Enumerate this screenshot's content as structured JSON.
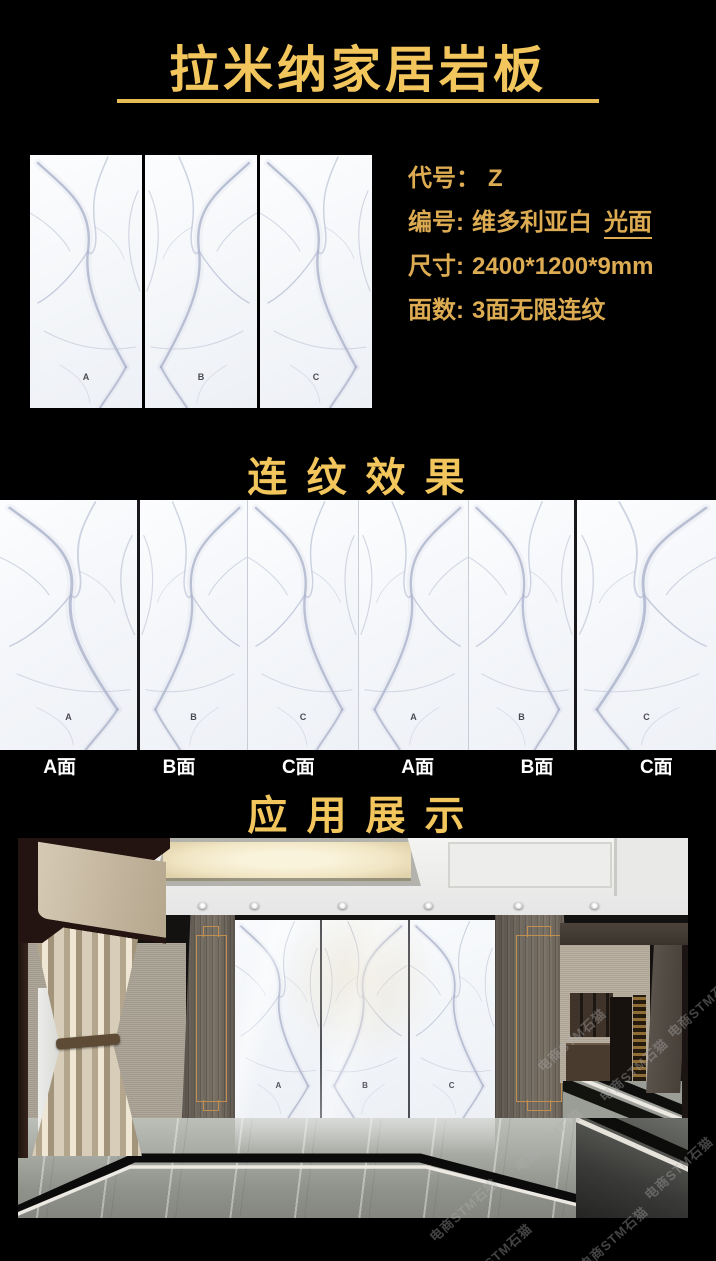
{
  "colors": {
    "background": "#000000",
    "heading_gold": "#F2C65C",
    "spec_gold": "#DCAB52",
    "label_white": "#FFFFFF"
  },
  "header": {
    "title": "拉米纳家居岩板"
  },
  "product": {
    "slab_letters": [
      "A",
      "B",
      "C"
    ],
    "specs": [
      {
        "label": "代号：",
        "value": "Z"
      },
      {
        "label": "编号:",
        "value": "维多利亚白",
        "extra": "光面"
      },
      {
        "label": "尺寸:",
        "value": "2400*1200*9mm"
      },
      {
        "label": "面数:",
        "value": "3面无限连纹"
      }
    ]
  },
  "continuous": {
    "heading": "连 纹 效 果",
    "slab_letters": [
      "A",
      "B",
      "C",
      "A",
      "B",
      "C"
    ],
    "face_labels": [
      "A面",
      "B面",
      "C面",
      "A面",
      "B面",
      "C面"
    ]
  },
  "application": {
    "heading": "应 用 展 示",
    "wall_letters": [
      "A",
      "B",
      "C"
    ]
  },
  "watermark": {
    "text": "电商STM石猫"
  }
}
